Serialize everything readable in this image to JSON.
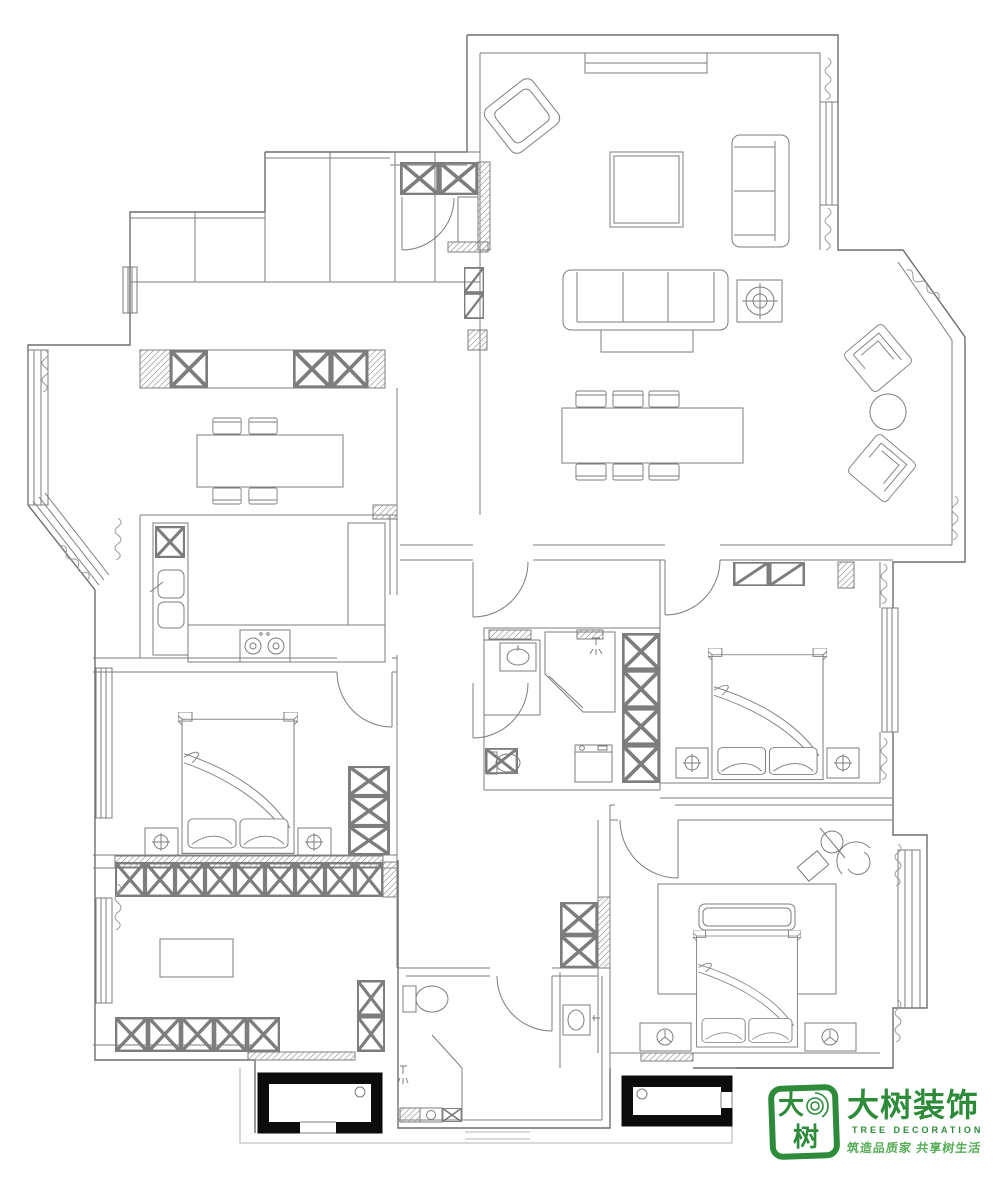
{
  "canvas": {
    "width": 1000,
    "height": 1183,
    "background": "#ffffff"
  },
  "drawing": {
    "type": "residential-floor-plan",
    "line_color": "#7d7d7d",
    "wall_color": "#6e6e6e",
    "platform_fill": "#0c0c0c"
  },
  "logo": {
    "seal_char_top": "大",
    "seal_char_bottom": "树",
    "chinese": "大树装饰",
    "english": "TREE DECORATION",
    "slogan": "筑造品质家  共享树生活",
    "green": "#2e8b3a",
    "slogan_green": "#55ad57"
  }
}
